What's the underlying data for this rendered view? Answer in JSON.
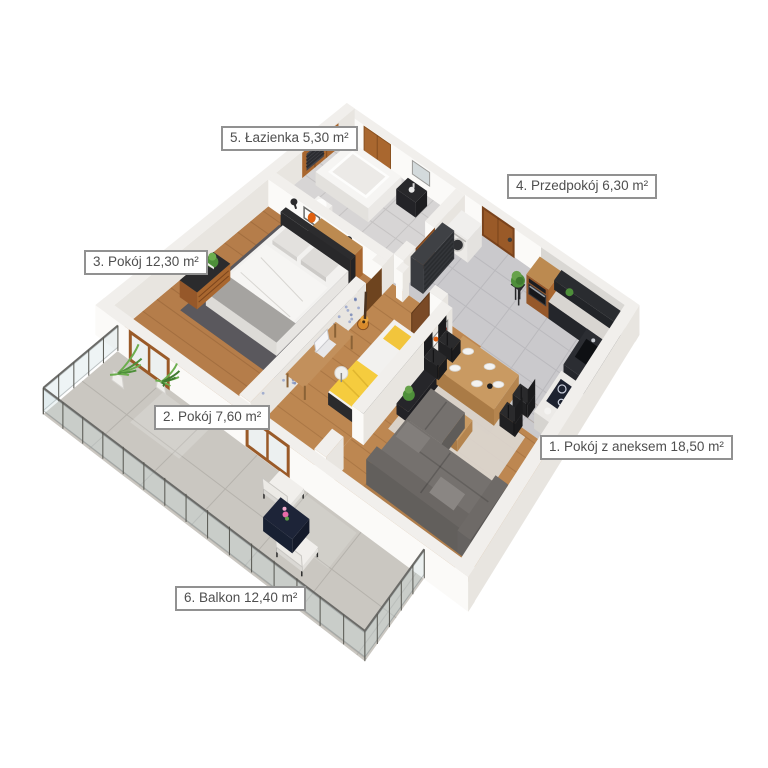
{
  "app": {
    "type": "3d-floor-plan-visualization",
    "background": "#ffffff"
  },
  "floorplan": {
    "style": "isometric-3d-render",
    "language": "pl",
    "rooms": [
      {
        "number": "1",
        "name": "Pokój z aneksem",
        "area": "18,50 m²",
        "label": "1. Pokój z aneksem 18,50 m²"
      },
      {
        "number": "2",
        "name": "Pokój",
        "area": "7,60 m²",
        "label": "2. Pokój 7,60 m²"
      },
      {
        "number": "3",
        "name": "Pokój",
        "area": "12,30 m²",
        "label": "3. Pokój 12,30 m²"
      },
      {
        "number": "4",
        "name": "Przedpokój",
        "area": "6,30 m²",
        "label": "4. Przedpokój 6,30 m²"
      },
      {
        "number": "5",
        "name": "Łazienka",
        "area": "5,30 m²",
        "label": "5. Łazienka 5,30 m²"
      },
      {
        "number": "6",
        "name": "Balkon",
        "area": "12,40 m²",
        "label": "6. Balkon 12,40 m²"
      }
    ],
    "colors": {
      "wood_floor": "#bd8751",
      "tile_floor": "#cac9cc",
      "balcony_floor": "#cbc8c2",
      "walls": "#f5f3f0",
      "kitchen_units": "#1f2125",
      "cabinet_wood": "#a9672f",
      "sofa": "#6f6b69",
      "accent_yellow": "#f5c832",
      "plant_green": "#4e8f3a",
      "door_wood": "#9a5a28"
    }
  }
}
